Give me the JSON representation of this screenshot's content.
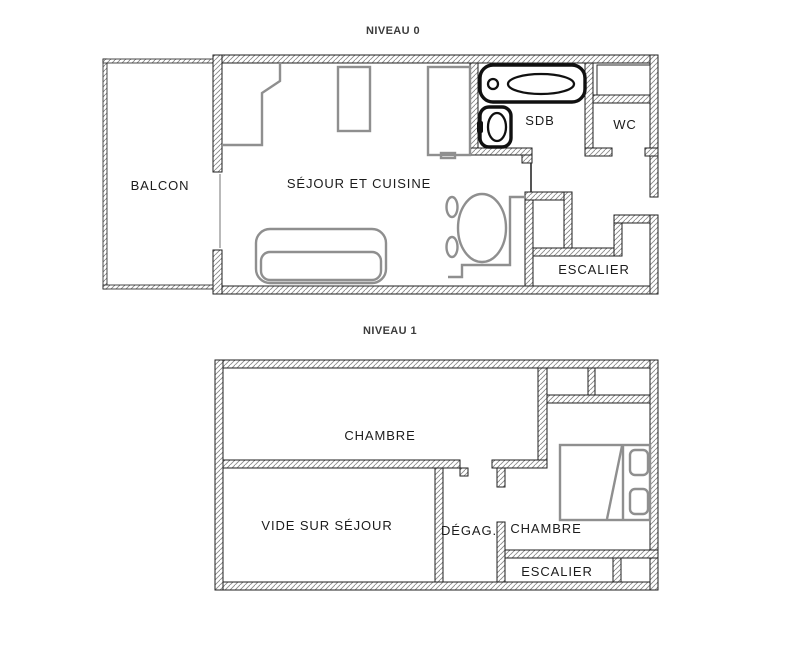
{
  "colors": {
    "wall_outline": "#1f1f1f",
    "hatch": "#8a8a8a",
    "furniture_gray": "#8f8f8f",
    "fixture_black": "#101010",
    "text": "#1c1c1c",
    "title": "#3c3c3c",
    "page_bg": "#ffffff"
  },
  "level0": {
    "title": "NIVEAU 0",
    "rooms": {
      "balcony": "BALCON",
      "living": "SÉJOUR ET CUISINE",
      "bathroom": "SDB",
      "toilet": "WC",
      "stairs": "ESCALIER"
    }
  },
  "level1": {
    "title": "NIVEAU 1",
    "rooms": {
      "bedroom_top": "CHAMBRE",
      "void": "VIDE SUR SÉJOUR",
      "hallway": "DÉGAG.",
      "bedroom_right": "CHAMBRE",
      "stairs": "ESCALIER"
    }
  }
}
